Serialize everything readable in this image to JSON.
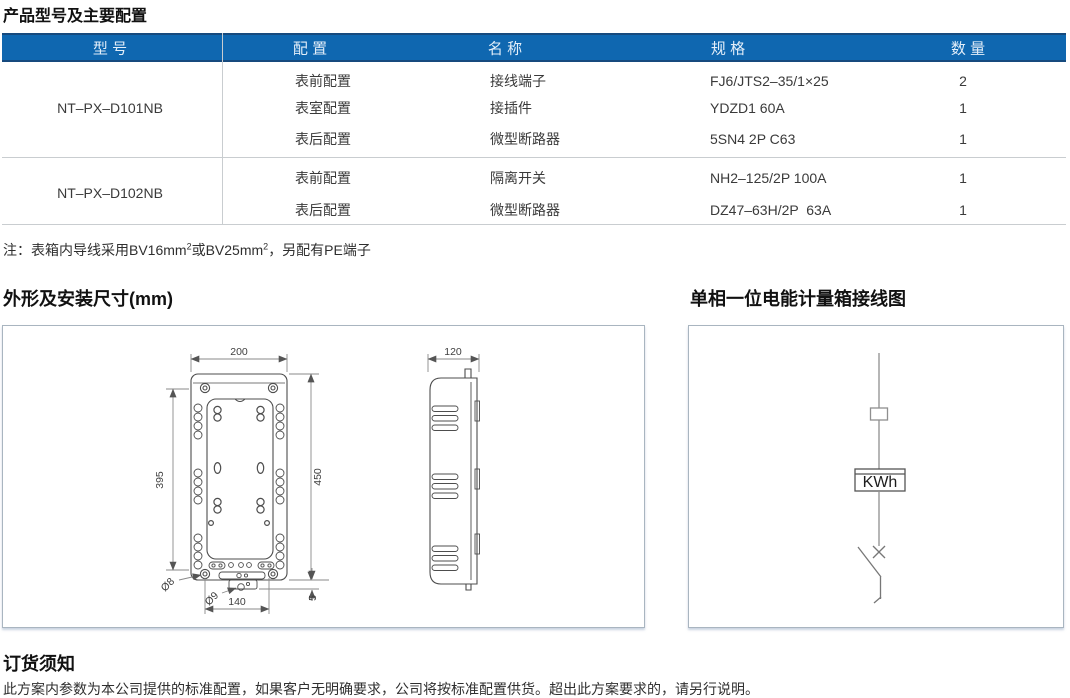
{
  "page": {
    "title": "产品型号及主要配置"
  },
  "table": {
    "headers": {
      "model": "型 号",
      "config": "配 置",
      "name": "名 称",
      "spec": "规 格",
      "qty": "数 量"
    },
    "groups": [
      {
        "model": "NT–PX–D101NB",
        "rows": [
          {
            "config": "表前配置",
            "name": "接线端子",
            "spec": "FJ6/JTS2–35/1×25",
            "qty": "2"
          },
          {
            "config": "表室配置",
            "name": "接插件",
            "spec": "YDZD1 60A",
            "qty": "1"
          },
          {
            "config": "表后配置",
            "name": "微型断路器",
            "spec": "5SN4 2P C63",
            "qty": "1"
          }
        ]
      },
      {
        "model": "NT–PX–D102NB",
        "rows": [
          {
            "config": "表前配置",
            "name": "隔离开关",
            "spec": "NH2–125/2P 100A",
            "qty": "1"
          },
          {
            "config": "表后配置",
            "name": "微型断路器",
            "spec": "DZ47–63H/2P  63A",
            "qty": "1"
          }
        ]
      }
    ]
  },
  "note": {
    "p1": "注：表箱内导线采用BV16mm",
    "sup1": "2",
    "p2": "或BV25mm",
    "sup2": "2",
    "p3": "，另配有PE端子"
  },
  "sections": {
    "dimensions_title": "外形及安装尺寸(mm)",
    "wiring_title": "单相一位电能计量箱接线图",
    "ordering_title": "订货须知",
    "ordering_text": "此方案内参数为本公司提供的标准配置，如果客户无明确要求，公司将按标准配置供货。超出此方案要求的，请另行说明。"
  },
  "dimensions": {
    "front_width": "200",
    "front_height": "450",
    "mount_height": "395",
    "mount_width": "140",
    "bottom_offset": "5",
    "hole_top": "Ø8",
    "hole_bottom": "Ø9",
    "side_depth": "120"
  },
  "wiring": {
    "meter_label": "KWh"
  },
  "colors": {
    "header_blue": "#0f67b0",
    "header_border": "#164a7e",
    "table_line": "#c9cdd0",
    "panel_border": "#a9b5c0"
  }
}
